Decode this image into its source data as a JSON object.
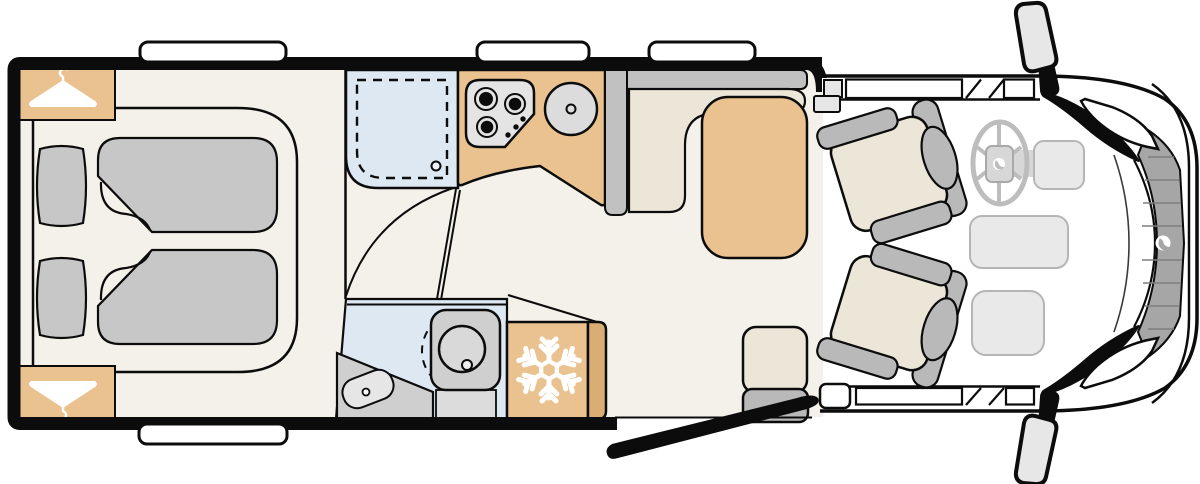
{
  "page": {
    "title": "Motorhome floor plan (top view)"
  },
  "colors": {
    "background": "#ffffff",
    "floor": "#f4f1ea",
    "wall": "#0c0c0c",
    "wood": "#e9c28f",
    "wood_dark": "#d9ad74",
    "gray_furniture": "#c7c7c7",
    "bench_gray": "#c1c1c1",
    "cushion_beige": "#ece6d9",
    "seat_gray": "#b9b9b9",
    "wetroom_blue": "#dde8f3",
    "appliance_gray": "#e4e4e4",
    "steel_gray": "#dcdcdc",
    "cab_line_gray": "#bdbdbd",
    "dash_fill": "#e9e9e9",
    "grille_gray": "#a6a6a6",
    "icon_white": "#ffffff"
  },
  "floorplan": {
    "type": "motorhome-floorplan",
    "view": "top-down",
    "areas": [
      {
        "id": "rear-bedroom",
        "label": "Rear bedroom with double bed, two pillows, two duvets and two wardrobes"
      },
      {
        "id": "washroom",
        "label": "Washroom with shower tray, swivel toilet and washbasin"
      },
      {
        "id": "kitchen",
        "label": "Kitchenette with 3-burner hob and round sink"
      },
      {
        "id": "refrigerator",
        "label": "Refrigerator with freezer symbol"
      },
      {
        "id": "dinette",
        "label": "L-shaped dinette bench with table and forward travel seat"
      },
      {
        "id": "cab",
        "label": "Driver cab with two swivelled captain seats, steering wheel and dashboard"
      }
    ],
    "icons": [
      {
        "name": "hanger-icon",
        "meaning": "wardrobe"
      },
      {
        "name": "hanger-icon-inverted",
        "meaning": "wardrobe"
      },
      {
        "name": "snowflake-icon",
        "meaning": "refrigerator / freezer"
      },
      {
        "name": "hob-icon",
        "meaning": "3-burner gas hob"
      },
      {
        "name": "sink-icon",
        "meaning": "kitchen sink"
      },
      {
        "name": "shower-icon",
        "meaning": "shower tray with drain"
      },
      {
        "name": "toilet-icon",
        "meaning": "swivel toilet"
      },
      {
        "name": "washbasin-icon",
        "meaning": "washbasin"
      },
      {
        "name": "steering-wheel-icon",
        "meaning": "driver position"
      },
      {
        "name": "wing-mirror-icon",
        "meaning": "exterior wing mirrors"
      },
      {
        "name": "entry-door-icon",
        "meaning": "entrance door shown open"
      },
      {
        "name": "grille-logo-icon",
        "meaning": "brand emblem on radiator grille"
      }
    ],
    "windows": {
      "habitation_top": 3,
      "habitation_bottom": 1,
      "cab_side_window_bands": 2
    }
  }
}
